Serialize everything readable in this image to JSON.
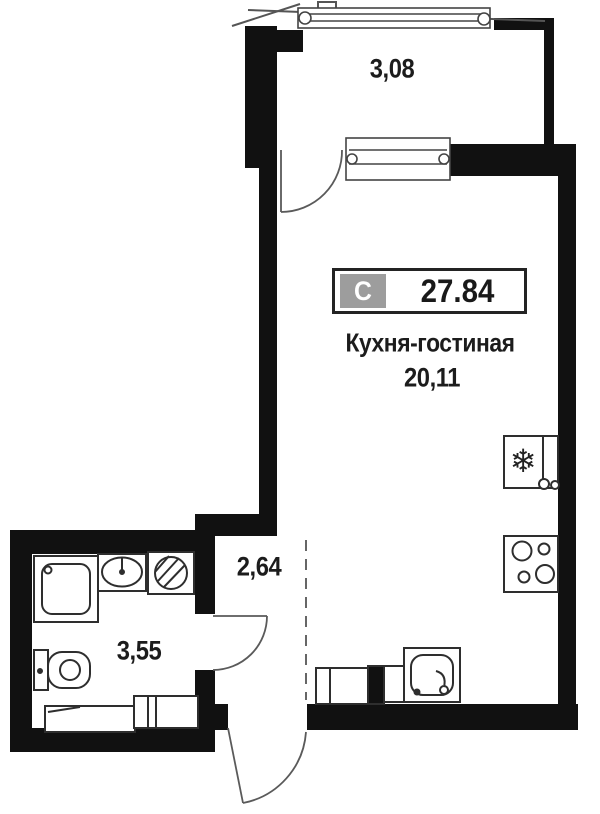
{
  "unit_badge": {
    "type_label": "С",
    "total_area": "27.84"
  },
  "rooms": {
    "balcony": {
      "area": "3,08"
    },
    "kitchen_living": {
      "name": "Кухня-гостиная",
      "area": "20,11"
    },
    "hallway": {
      "area": "2,64"
    },
    "bathroom": {
      "area": "3,55"
    }
  },
  "icons": {
    "fridge": {
      "name": "snowflake-icon",
      "glyph": "❄"
    }
  },
  "fixtures": {
    "bathroom": [
      "shower-tray",
      "washbasin",
      "washing-machine",
      "toilet",
      "cabinet-low",
      "cabinet-divided"
    ],
    "kitchen": [
      "fridge",
      "stove-4-burners",
      "kitchen-sink",
      "kitchen-cabinet",
      "kitchen-duct"
    ]
  },
  "features": {
    "windows": [
      "balcony-glazing",
      "balcony-partition-window"
    ],
    "doors": [
      "balcony-door",
      "bathroom-door",
      "entrance-door"
    ],
    "virtual_boundary": "kitchen-hallway-dashed-line"
  },
  "colors": {
    "background": "#ffffff",
    "wall": "#111111",
    "fixture_line": "#2e2e2e",
    "thin_line": "#555555",
    "dashed_line": "#666666",
    "badge_border": "#232323",
    "badge_gray": "#9d9d9d",
    "text": "#1c1c1c"
  }
}
